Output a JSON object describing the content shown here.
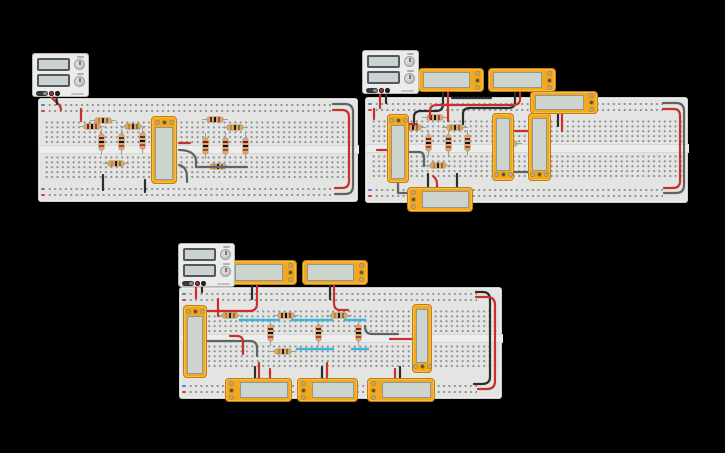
{
  "app": {
    "name": "circuit-design-canvas",
    "background": "#000000"
  },
  "palette": {
    "board_fill": "#e4e4e2",
    "module_body": "#f2a81f",
    "module_screen": "#cdd3cd",
    "resistor_body": "#d4a96f",
    "wire": {
      "red": "#c9302c",
      "black": "#2b2e30",
      "gray": "#5d6367",
      "cyan": "#3db5d8"
    },
    "rail_negative": "#4f86c2",
    "rail_positive": "#cc4040",
    "bands": {
      "a": [
        "#d87f1f",
        "#1d1d1d",
        "#9a6a28"
      ],
      "b": [
        "#7e1f1f",
        "#101010",
        "#c23b2f"
      ]
    }
  },
  "components": {
    "power_supply_count": 3,
    "breadboard_count": 3,
    "ic_module_count": 15,
    "resistor_count": 25
  },
  "circuits": [
    {
      "name": "top-left-circuit",
      "psu": {
        "x": 32,
        "y": 53,
        "w": 57,
        "h": 44
      },
      "board": {
        "x": 38,
        "y": 98,
        "w": 320,
        "h": 104
      },
      "modules": [
        {
          "x": 151,
          "y": 116,
          "w": 26,
          "h": 68,
          "pins": "top"
        }
      ],
      "resistors": {
        "h": [
          [
            95,
            118,
            "a"
          ],
          [
            84,
            124,
            "b"
          ],
          [
            125,
            124,
            "a"
          ],
          [
            207,
            117,
            "b"
          ],
          [
            227,
            125,
            "a"
          ],
          [
            108,
            161,
            "a"
          ],
          [
            210,
            164,
            "a"
          ]
        ],
        "v": [
          [
            99,
            134,
            "b"
          ],
          [
            119,
            134,
            "b"
          ],
          [
            140,
            133,
            "b"
          ],
          [
            203,
            138,
            "b"
          ],
          [
            223,
            138,
            "b"
          ],
          [
            243,
            138,
            "b"
          ]
        ]
      },
      "wires": [
        [
          "red",
          "M50,92 C50,101 61,102 61,110"
        ],
        [
          "black",
          "M56,92 C56,99 57,99 57,104"
        ],
        [
          "red",
          "M81,109 V121"
        ],
        [
          "red",
          "M179,143 H190"
        ],
        [
          "gray",
          "M179,150 C191,150 196,155 196,161 V167 H247"
        ],
        [
          "gray",
          "M179,165 C188,167 187,176 187,182"
        ],
        [
          "black",
          "M103,175 V190"
        ],
        [
          "black",
          "M145,180 V192"
        ],
        [
          "gray",
          "M333,104 H345 Q353,104 353,112 V186 Q353,194 345,194 H335"
        ],
        [
          "red",
          "M333,110 H342 Q349,110 349,117 V181 Q349,188 342,188 H335"
        ]
      ]
    },
    {
      "name": "top-right-circuit",
      "psu": {
        "x": 362,
        "y": 50,
        "w": 57,
        "h": 44
      },
      "board": {
        "x": 365,
        "y": 97,
        "w": 323,
        "h": 106
      },
      "modules": [
        {
          "x": 418,
          "y": 68,
          "w": 66,
          "h": 24,
          "pins": "right"
        },
        {
          "x": 488,
          "y": 68,
          "w": 68,
          "h": 24,
          "pins": "right"
        },
        {
          "x": 530,
          "y": 91,
          "w": 68,
          "h": 23,
          "pins": "right"
        },
        {
          "x": 387,
          "y": 114,
          "w": 22,
          "h": 69,
          "pins": "top"
        },
        {
          "x": 492,
          "y": 113,
          "w": 22,
          "h": 68,
          "pins": "bottom"
        },
        {
          "x": 528,
          "y": 113,
          "w": 23,
          "h": 68,
          "pins": "bottom"
        },
        {
          "x": 407,
          "y": 187,
          "w": 66,
          "h": 25,
          "pins": "left"
        }
      ],
      "resistors": {
        "h": [
          [
            427,
            115,
            "b"
          ],
          [
            405,
            125,
            "a"
          ],
          [
            447,
            125,
            "a"
          ],
          [
            430,
            163,
            "a"
          ],
          [
            501,
            141,
            "a"
          ]
        ],
        "v": [
          [
            426,
            135,
            "b"
          ],
          [
            446,
            135,
            "b"
          ],
          [
            465,
            135,
            "b"
          ]
        ]
      },
      "wires": [
        [
          "red",
          "M380,89 V108"
        ],
        [
          "black",
          "M386,89 V103"
        ],
        [
          "red",
          "M374,109 V119"
        ],
        [
          "black",
          "M443,92 V104 Q443,111 436,111 H421 Q414,111 414,117 V125"
        ],
        [
          "red",
          "M448,92 V121"
        ],
        [
          "black",
          "M515,92 V102 Q515,108 508,108 H470 Q463,108 463,114 V124"
        ],
        [
          "red",
          "M520,92 V99 Q520,105 513,105 H437 Q430,105 430,111 V118"
        ],
        [
          "black",
          "M491,98 H452"
        ],
        [
          "black",
          "M558,113 V126"
        ],
        [
          "red",
          "M562,113 V131"
        ],
        [
          "red",
          "M409,124 H417"
        ],
        [
          "red",
          "M377,150 H387"
        ],
        [
          "gray",
          "M409,152 H419 Q424,152 424,158 V166"
        ],
        [
          "red",
          "M514,131 H528"
        ],
        [
          "gray",
          "M514,172 H528"
        ],
        [
          "black",
          "M428,174 V188"
        ],
        [
          "red",
          "M433,176 Q437,179 437,184 V188"
        ],
        [
          "black",
          "M457,174 V188"
        ],
        [
          "gray",
          "M398,183 V193 H414"
        ],
        [
          "gray",
          "M663,103 H676 Q684,103 684,111 V185 Q684,193 676,193 H664"
        ],
        [
          "red",
          "M663,109 H674 Q680,109 680,116 V181 Q680,188 673,188 H664"
        ]
      ]
    },
    {
      "name": "bottom-circuit",
      "psu": {
        "x": 178,
        "y": 243,
        "w": 57,
        "h": 44
      },
      "board": {
        "x": 179,
        "y": 287,
        "w": 323,
        "h": 112
      },
      "modules": [
        {
          "x": 183,
          "y": 305,
          "w": 24,
          "h": 73,
          "pins": "top"
        },
        {
          "x": 412,
          "y": 304,
          "w": 20,
          "h": 69,
          "pins": "bottom"
        },
        {
          "x": 230,
          "y": 260,
          "w": 67,
          "h": 25,
          "pins": "right"
        },
        {
          "x": 302,
          "y": 260,
          "w": 66,
          "h": 25,
          "pins": "right"
        },
        {
          "x": 225,
          "y": 378,
          "w": 67,
          "h": 24,
          "pins": "left"
        },
        {
          "x": 297,
          "y": 378,
          "w": 61,
          "h": 24,
          "pins": "left"
        },
        {
          "x": 367,
          "y": 378,
          "w": 68,
          "h": 24,
          "pins": "left"
        }
      ],
      "resistors": {
        "h": [
          [
            222,
            313,
            "a"
          ],
          [
            278,
            313,
            "b"
          ],
          [
            331,
            313,
            "a"
          ],
          [
            275,
            349,
            "a"
          ]
        ],
        "v": [
          [
            268,
            325,
            "b"
          ],
          [
            316,
            325,
            "b"
          ],
          [
            356,
            325,
            "b"
          ]
        ]
      },
      "wires": [
        [
          "red",
          "M196,282 V298"
        ],
        [
          "black",
          "M202,282 V292"
        ],
        [
          "red",
          "M218,299 V316"
        ],
        [
          "red",
          "M207,311 H249 Q257,311 257,304 V285"
        ],
        [
          "black",
          "M252,285 V299"
        ],
        [
          "black",
          "M330,285 V299"
        ],
        [
          "red",
          "M334,285 V303 Q334,310 340,310 H348"
        ],
        [
          "gray",
          "M207,341 H250 Q257,341 257,348 V356"
        ],
        [
          "red",
          "M230,336 H237 Q243,336 243,342 V354"
        ],
        [
          "black",
          "M255,378 V367"
        ],
        [
          "red",
          "M259,378 V363"
        ],
        [
          "red",
          "M270,378 V369"
        ],
        [
          "black",
          "M322,378 V367"
        ],
        [
          "red",
          "M327,378 V363"
        ],
        [
          "red",
          "M395,378 V369"
        ],
        [
          "black",
          "M400,378 V367"
        ],
        [
          "gray",
          "M365,326 Q365,334 372,334 H398"
        ],
        [
          "red",
          "M390,339 H412"
        ],
        [
          "black",
          "M476,292 H483 Q490,292 490,300 V377 Q490,384 482,384 H474"
        ],
        [
          "red",
          "M476,297 H487 Q495,297 495,305 V381 Q495,389 487,389 H478"
        ],
        [
          "cyan",
          "M240,320 H279"
        ],
        [
          "cyan",
          "M292,320 H332"
        ],
        [
          "cyan",
          "M345,320 H365"
        ],
        [
          "cyan",
          "M297,349 H333"
        ],
        [
          "cyan",
          "M352,349 H368"
        ]
      ]
    }
  ]
}
